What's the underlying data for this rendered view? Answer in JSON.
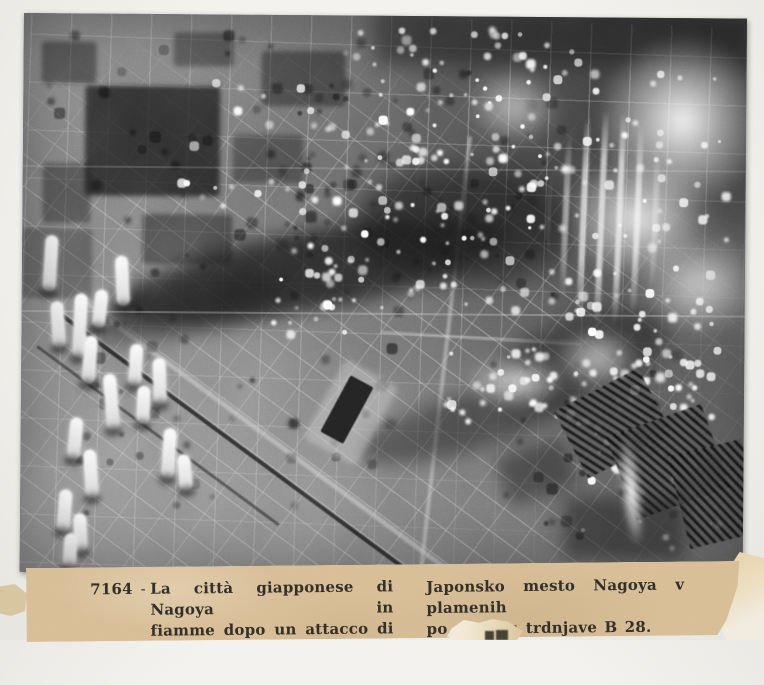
{
  "caption": {
    "left": {
      "number": "7164",
      "dash": "-",
      "lines": [
        "La città giapponese di Nagoya in",
        "fiamme dopo un attacco di superfor-",
        "tezze B. 28."
      ]
    },
    "right": {
      "lines": [
        "Japonsko mesto Nagoya v plamenih",
        "po napadu trdnjave B 28."
      ]
    }
  },
  "colors": {
    "caption_paper": "#dcc29b",
    "caption_ink": "#33302a",
    "mount_paper": "#f1f0ec"
  }
}
